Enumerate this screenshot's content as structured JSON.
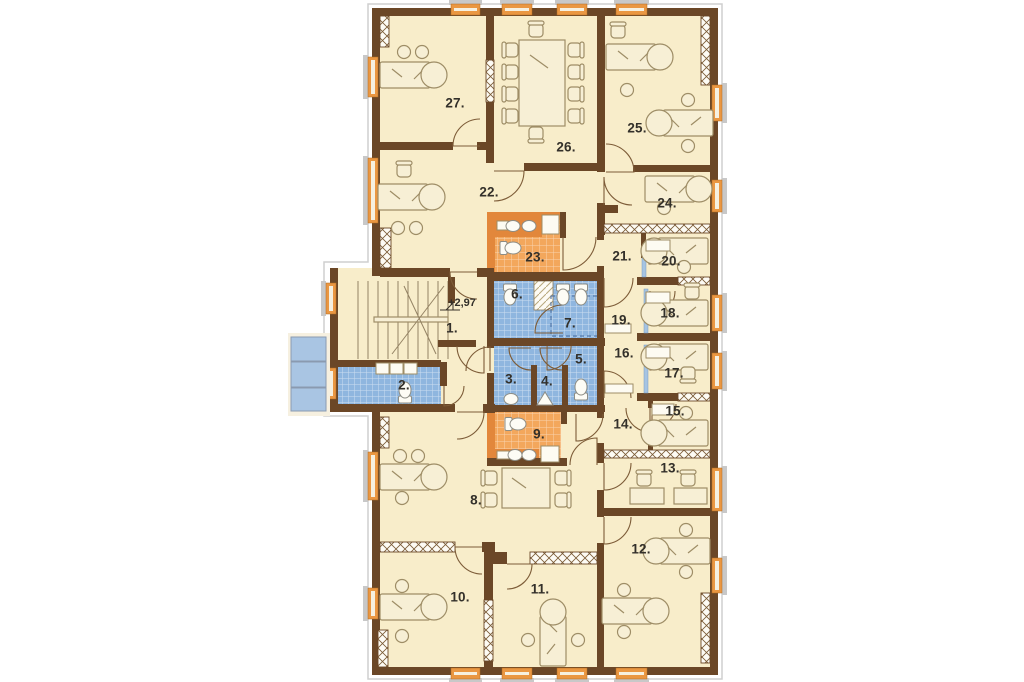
{
  "plan": {
    "type": "architectural-floor-plan",
    "level_marker": "+2,97",
    "rooms": [
      {
        "id": "1",
        "label": "1.",
        "kind": "staircase-hall"
      },
      {
        "id": "2",
        "label": "2.",
        "kind": "bathroom-blue"
      },
      {
        "id": "3",
        "label": "3.",
        "kind": "bathroom-blue"
      },
      {
        "id": "4",
        "label": "4.",
        "kind": "bathroom-blue"
      },
      {
        "id": "5",
        "label": "5.",
        "kind": "bathroom-blue"
      },
      {
        "id": "6",
        "label": "6.",
        "kind": "bathroom-blue"
      },
      {
        "id": "7",
        "label": "7.",
        "kind": "bathroom-blue"
      },
      {
        "id": "8",
        "label": "8.",
        "kind": "office-hall"
      },
      {
        "id": "9",
        "label": "9.",
        "kind": "bathroom-orange"
      },
      {
        "id": "10",
        "label": "10.",
        "kind": "office"
      },
      {
        "id": "11",
        "label": "11.",
        "kind": "office"
      },
      {
        "id": "12",
        "label": "12.",
        "kind": "office"
      },
      {
        "id": "13",
        "label": "13.",
        "kind": "office"
      },
      {
        "id": "14",
        "label": "14.",
        "kind": "anteroom"
      },
      {
        "id": "15",
        "label": "15.",
        "kind": "office"
      },
      {
        "id": "16",
        "label": "16.",
        "kind": "corridor"
      },
      {
        "id": "17",
        "label": "17.",
        "kind": "office"
      },
      {
        "id": "18",
        "label": "18.",
        "kind": "office"
      },
      {
        "id": "19",
        "label": "19.",
        "kind": "corridor"
      },
      {
        "id": "20",
        "label": "20.",
        "kind": "office"
      },
      {
        "id": "21",
        "label": "21.",
        "kind": "anteroom"
      },
      {
        "id": "22",
        "label": "22.",
        "kind": "hall"
      },
      {
        "id": "23",
        "label": "23.",
        "kind": "bathroom-orange"
      },
      {
        "id": "24",
        "label": "24.",
        "kind": "office"
      },
      {
        "id": "25",
        "label": "25.",
        "kind": "office"
      },
      {
        "id": "26",
        "label": "26.",
        "kind": "conference-room"
      },
      {
        "id": "27",
        "label": "27.",
        "kind": "office"
      }
    ],
    "colors": {
      "wall": "#6b4727",
      "floor": "#f8edca",
      "tile_blue": "#8fb6df",
      "tile_orange": "#f3a75c",
      "fixture_orange": "#e2873b",
      "window_frame": "#ea9742",
      "exterior_blue": "#a9c5e3",
      "glass_partition": "#a6c4e2",
      "furniture_line": "#9e8d66",
      "label_text": "#33302a"
    }
  }
}
